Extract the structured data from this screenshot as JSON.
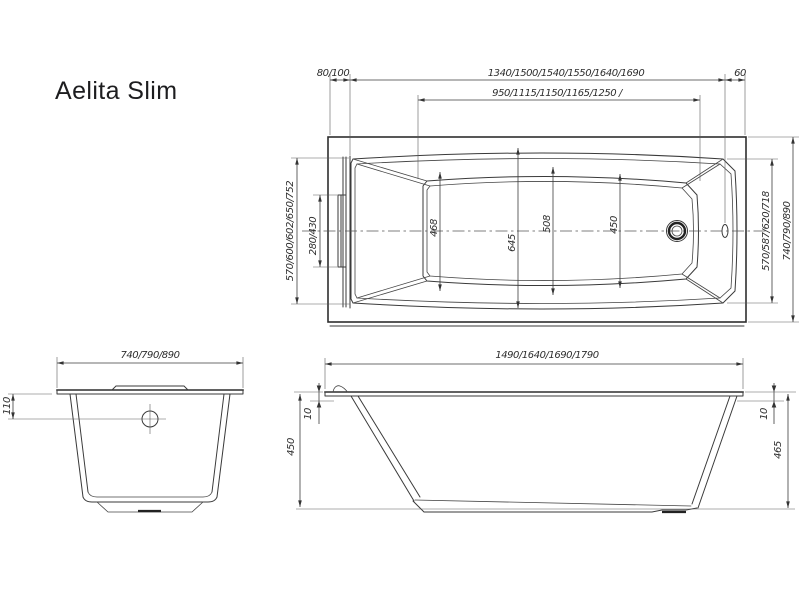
{
  "title": "Aelita Slim",
  "colors": {
    "background": "#ffffff",
    "line": "#2e2e2e",
    "dimension_line": "#3d3d3d",
    "text": "#1d1d1f"
  },
  "views": {
    "plan": {
      "dims": {
        "edge_to_headrest": "80/100",
        "headrest_to_overflow": "1340/1500/1540/1550/1640/1690",
        "overflow_to_edge": "60",
        "bottom_length": "950/1115/1150/1165/1250 /",
        "inner_width_left": "570/600/602/650/752",
        "headrest_width": "280/430",
        "bottom_width_head": "468",
        "rim_width_max": "645",
        "bottom_width_mid": "508",
        "bottom_width_foot": "450",
        "inner_width_right": "570/587/620/718",
        "overall_width": "740/790/890"
      }
    },
    "end": {
      "dims": {
        "overall_width": "740/790/890",
        "overflow_depth": "110"
      }
    },
    "side": {
      "dims": {
        "overall_length": "1490/1640/1690/1790",
        "rim_lip_left": "10",
        "rim_lip_right": "10",
        "height_left": "450",
        "height_right": "465"
      }
    }
  }
}
